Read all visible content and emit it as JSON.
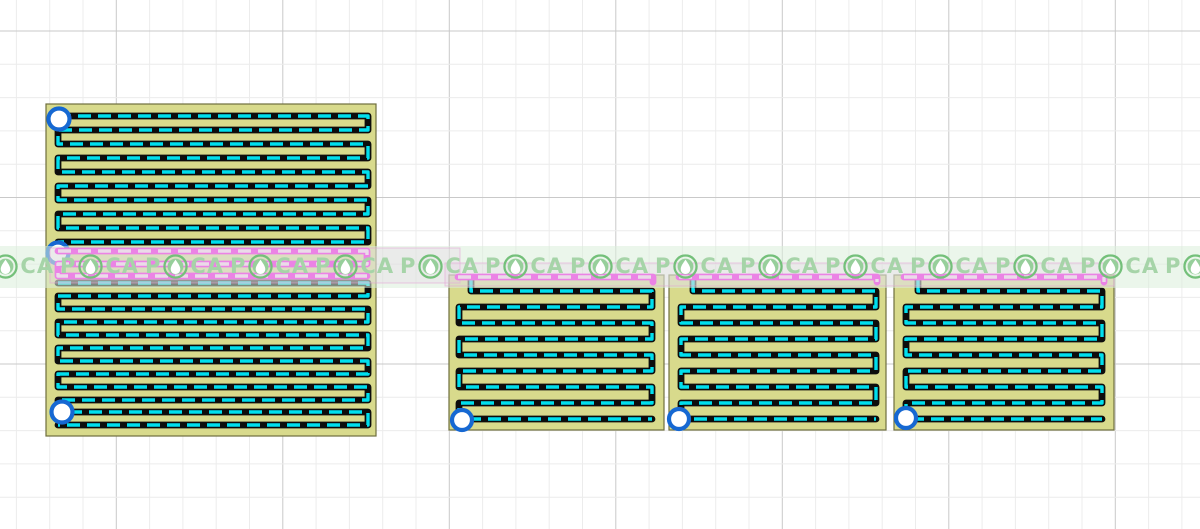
{
  "canvas": {
    "width": 1200,
    "height": 529,
    "background": "#ffffff"
  },
  "grid": {
    "step": 33.3,
    "x_start": 16.4,
    "y_start": 31,
    "major_every": 5,
    "x_major_offset": 3,
    "y_major_offset": 0,
    "minor_color": "#ececec",
    "major_color": "#c9c9c9"
  },
  "colors": {
    "board_fill": "#d8da8c",
    "board_edge": "#6e6e3e",
    "trace_base": "#0d0d0d",
    "trace_dash": "#00dfee",
    "selected_base": "#ff00f2",
    "selected_dash": "#ffc3fa",
    "pad_ring": "#1668d2",
    "pad_fill": "#ffffff",
    "selection_fill": "rgba(247,141,242,0.22)",
    "selection_border": "rgba(238,62,206,0.55)",
    "handle_fill": "#ffffff",
    "handle_ring": "#e85cc4"
  },
  "trace_style": {
    "base_width": 6.8,
    "dash_width": 3.4,
    "dash_array": "13 7"
  },
  "boards": [
    {
      "name": "board-main",
      "rect": {
        "x": 46,
        "y": 104,
        "w": 330,
        "h": 332
      },
      "traces": [
        {
          "kind": "normal",
          "rows": [
            116,
            130,
            144,
            158,
            172,
            186,
            200,
            214,
            228,
            242
          ],
          "x1": 58,
          "x2": 368
        },
        {
          "kind": "selected",
          "rows": [
            251,
            264,
            276
          ],
          "x1": 58,
          "x2": 367
        },
        {
          "kind": "normal",
          "rows": [
            283,
            296,
            309,
            322,
            335,
            348,
            361,
            374,
            387,
            400,
            412,
            425
          ],
          "x1": 58,
          "x2": 368
        }
      ],
      "pads": [
        {
          "x": 59,
          "y": 119,
          "r": 10.5
        },
        {
          "x": 58,
          "y": 253,
          "r": 10.5
        },
        {
          "x": 62,
          "y": 412,
          "r": 10.5
        }
      ]
    },
    {
      "name": "board-panel-1",
      "rect": {
        "x": 449,
        "y": 275,
        "w": 215,
        "h": 155
      },
      "traces": [
        {
          "kind": "selected",
          "rows": [
            277
          ],
          "x1": 458,
          "x2": 653,
          "end_hook": 282
        },
        {
          "kind": "normal",
          "rows": [
            291,
            307,
            323,
            339,
            355,
            371,
            387,
            403,
            419
          ],
          "x1": 459,
          "x2": 652,
          "lead": [
            471,
            280
          ]
        }
      ],
      "pads": [
        {
          "x": 462,
          "y": 420,
          "r": 10
        }
      ]
    },
    {
      "name": "board-panel-2",
      "rect": {
        "x": 669,
        "y": 275,
        "w": 217,
        "h": 155
      },
      "traces": [
        {
          "kind": "selected",
          "rows": [
            277
          ],
          "x1": 679,
          "x2": 877,
          "end_hook": 282
        },
        {
          "kind": "normal",
          "rows": [
            291,
            307,
            323,
            339,
            355,
            371,
            387,
            403,
            419
          ],
          "x1": 681,
          "x2": 876,
          "lead": [
            693,
            280
          ]
        }
      ],
      "pads": [
        {
          "x": 679,
          "y": 419,
          "r": 10
        }
      ]
    },
    {
      "name": "board-panel-3",
      "rect": {
        "x": 894,
        "y": 275,
        "w": 220,
        "h": 155
      },
      "traces": [
        {
          "kind": "selected",
          "rows": [
            277
          ],
          "x1": 904,
          "x2": 1104,
          "end_hook": 282
        },
        {
          "kind": "normal",
          "rows": [
            291,
            307,
            323,
            339,
            355,
            371,
            387,
            403,
            419
          ],
          "x1": 906,
          "x2": 1102,
          "lead": [
            918,
            280
          ]
        }
      ],
      "pads": [
        {
          "x": 906,
          "y": 418,
          "r": 10
        }
      ]
    }
  ],
  "selection_boxes": [
    {
      "name": "selection-box-left",
      "x": 50,
      "y": 248,
      "w": 410,
      "h": 35
    },
    {
      "name": "selection-box-right",
      "x": 445,
      "y": 263,
      "w": 669,
      "h": 23,
      "handle": {
        "x": 1114,
        "y": 264,
        "r": 3.5
      }
    }
  ],
  "watermark": {
    "part_p": "P",
    "part_ca": "CA",
    "band": {
      "y": 246,
      "h": 42,
      "color": "rgba(219,239,219,0.55)"
    },
    "unit_spacing": 85,
    "first_logo_x": 3,
    "count": 15,
    "center_y": 266,
    "font_size": 21,
    "text_color": "#a6d4a8",
    "logo_ring": "#74c07a",
    "logo_disc": "#97cf9b",
    "logo_drop": "#ffffff",
    "logo_diameter": 25
  }
}
